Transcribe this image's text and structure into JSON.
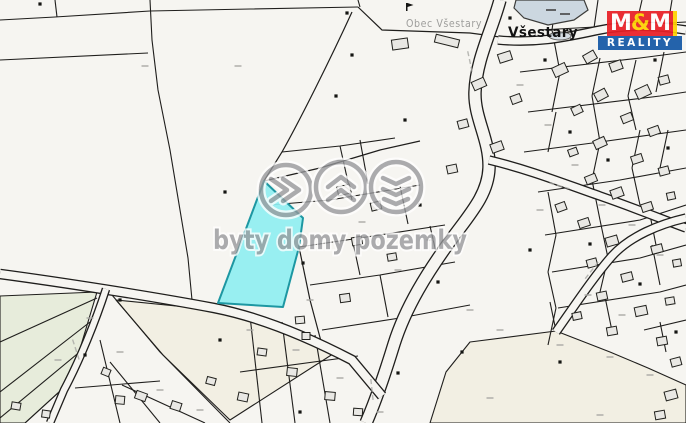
{
  "canvas": {
    "width": 686,
    "height": 423,
    "bg": "#f6f5f1",
    "line_color": "#1f1e1c",
    "building_fill": "#e9e8e4",
    "building_stroke": "#21211d",
    "green_fill": "#e7ecdb",
    "beige_fill": "#f2efe3",
    "pond_fill": "#ccd7e0",
    "pond_stroke": "#3c3c3a",
    "highlight_fill": "#8feef1",
    "highlight_stroke": "#1d97a2",
    "road_fill": "#f6f5f1",
    "mark_color": "#a8a8a4",
    "dot_color": "#141412"
  },
  "labels": {
    "town": "Všestary",
    "municipality": "Obec Všestary"
  },
  "watermark": {
    "text": "byty domy pozemky",
    "icons": [
      "fast-forward-icon",
      "roof-icon",
      "layers-icon"
    ],
    "color": "#96979a"
  },
  "logo": {
    "m1": "M",
    "amp": "&",
    "m2": "M",
    "bottom": "REALITY",
    "red": "#e81e25",
    "blue": "#1357a6",
    "yellow": "#ffd200"
  },
  "geometry": {
    "polygons": [
      {
        "kind": "green",
        "pts": [
          [
            0,
            296
          ],
          [
            97,
            292
          ],
          [
            70,
            382
          ],
          [
            25,
            423
          ],
          [
            0,
            423
          ]
        ]
      },
      {
        "kind": "beige",
        "pts": [
          [
            116,
            300
          ],
          [
            216,
            310
          ],
          [
            280,
            328
          ],
          [
            336,
            352
          ],
          [
            230,
            420
          ],
          [
            163,
            355
          ]
        ]
      },
      {
        "kind": "beige",
        "pts": [
          [
            430,
            423
          ],
          [
            446,
            372
          ],
          [
            470,
            342
          ],
          [
            556,
            331
          ],
          [
            610,
            352
          ],
          [
            648,
            368
          ],
          [
            686,
            385
          ],
          [
            686,
            423
          ]
        ]
      }
    ],
    "lines": [
      [
        150,
        0,
        152,
        40,
        158,
        90,
        170,
        150,
        180,
        210,
        188,
        258,
        192,
        300
      ],
      [
        0,
        20,
        55,
        17,
        150,
        11
      ],
      [
        55,
        0,
        57,
        17
      ],
      [
        0,
        60,
        148,
        53
      ],
      [
        150,
        11,
        250,
        9,
        358,
        7
      ],
      [
        358,
        0,
        360,
        7
      ],
      [
        282,
        152,
        340,
        146,
        395,
        138
      ],
      [
        270,
        205,
        330,
        200,
        420,
        185
      ],
      [
        299,
        247,
        360,
        238,
        445,
        225
      ],
      [
        310,
        285,
        380,
        275,
        455,
        262
      ],
      [
        322,
        330,
        400,
        318,
        470,
        305
      ],
      [
        340,
        146,
        352,
        200
      ],
      [
        360,
        140,
        368,
        184
      ],
      [
        352,
        238,
        360,
        275
      ],
      [
        400,
        186,
        408,
        224
      ],
      [
        380,
        275,
        388,
        317
      ],
      [
        430,
        226,
        438,
        261
      ],
      [
        540,
        30,
        686,
        22
      ],
      [
        520,
        72,
        640,
        58,
        686,
        52
      ],
      [
        528,
        112,
        660,
        96,
        686,
        92
      ],
      [
        524,
        152,
        600,
        142,
        686,
        130
      ],
      [
        538,
        192,
        620,
        180,
        686,
        168
      ],
      [
        545,
        235,
        640,
        220,
        686,
        205
      ],
      [
        552,
        272,
        640,
        258,
        686,
        245
      ],
      [
        558,
        308,
        660,
        292,
        686,
        285
      ],
      [
        644,
        330,
        686,
        320
      ],
      [
        556,
        0,
        552,
        30
      ],
      [
        598,
        0,
        594,
        28
      ],
      [
        642,
        0,
        636,
        26
      ],
      [
        672,
        0,
        668,
        24
      ],
      [
        552,
        30,
        560,
        72
      ],
      [
        560,
        72,
        552,
        112
      ],
      [
        556,
        112,
        548,
        152
      ],
      [
        600,
        58,
        592,
        96
      ],
      [
        592,
        96,
        600,
        142
      ],
      [
        636,
        60,
        628,
        96
      ],
      [
        628,
        96,
        636,
        130
      ],
      [
        664,
        52,
        656,
        92
      ],
      [
        600,
        142,
        592,
        180
      ],
      [
        640,
        130,
        632,
        168
      ],
      [
        668,
        130,
        660,
        168
      ],
      [
        548,
        192,
        556,
        235
      ],
      [
        592,
        180,
        600,
        220
      ],
      [
        632,
        168,
        640,
        205
      ],
      [
        556,
        235,
        548,
        272
      ],
      [
        600,
        220,
        608,
        258
      ],
      [
        648,
        205,
        656,
        245
      ],
      [
        548,
        272,
        556,
        308
      ],
      [
        608,
        258,
        600,
        292
      ],
      [
        652,
        245,
        660,
        285
      ],
      [
        556,
        308,
        548,
        345
      ],
      [
        604,
        292,
        612,
        331
      ],
      [
        660,
        322,
        666,
        352
      ],
      [
        97,
        298,
        0,
        342
      ],
      [
        90,
        322,
        0,
        392
      ],
      [
        82,
        350,
        0,
        418
      ],
      [
        70,
        382,
        25,
        423
      ],
      [
        112,
        295,
        160,
        352,
        230,
        423
      ],
      [
        100,
        340,
        120,
        423
      ],
      [
        110,
        362,
        160,
        423
      ],
      [
        122,
        385,
        205,
        423
      ],
      [
        75,
        388,
        160,
        381
      ],
      [
        250,
        316,
        262,
        423
      ],
      [
        282,
        322,
        295,
        423
      ],
      [
        315,
        335,
        330,
        423
      ],
      [
        240,
        372,
        358,
        356
      ],
      [
        556,
        331,
        550,
        302
      ]
    ],
    "curves": [
      "M352,12 C330,60 300,120 282,152 L264,181",
      "M358,7 L382,30 L470,33 L500,37",
      "M264,181 L320,168 L380,150 L420,141",
      "M299,247 L310,300 L322,345"
    ],
    "roads": [
      {
        "d": "M500,0 C492,30 476,60 475,92 C474,118 490,140 489,168 C488,196 468,216 448,244 C428,272 406,306 394,344 C386,370 376,400 366,423",
        "w": 11
      },
      {
        "d": "M0,274 C60,282 150,296 214,308 C260,317 306,336 352,360 L382,396",
        "w": 8
      },
      {
        "d": "M106,289 C96,320 80,360 64,390 L50,423",
        "w": 6
      },
      {
        "d": "M498,40 C540,44 570,36 600,30 C630,24 660,26 686,30",
        "w": 7
      },
      {
        "d": "M489,160 C530,170 560,182 600,196 C640,210 664,220 686,228",
        "w": 7
      },
      {
        "d": "M556,332 C575,305 595,275 612,256 C630,236 660,224 686,218",
        "w": 7
      }
    ],
    "pond": [
      [
        516,
        0
      ],
      [
        584,
        0
      ],
      [
        588,
        10
      ],
      [
        574,
        20
      ],
      [
        548,
        25
      ],
      [
        524,
        18
      ],
      [
        514,
        8
      ]
    ],
    "pond2": {
      "cx": 560,
      "cy": 36,
      "rx": 11,
      "ry": 4
    },
    "highlight": [
      [
        264,
        181
      ],
      [
        303,
        218
      ],
      [
        299,
        247
      ],
      [
        283,
        307
      ],
      [
        218,
        303
      ]
    ],
    "buildings": [
      [
        400,
        44,
        16,
        10,
        -8
      ],
      [
        447,
        41,
        24,
        8,
        14
      ],
      [
        505,
        57,
        13,
        9,
        -18
      ],
      [
        479,
        84,
        13,
        9,
        -24
      ],
      [
        516,
        99,
        10,
        8,
        -20
      ],
      [
        463,
        124,
        10,
        8,
        -15
      ],
      [
        497,
        147,
        12,
        9,
        -20
      ],
      [
        452,
        169,
        10,
        8,
        -12
      ],
      [
        344,
        190,
        13,
        9,
        -14
      ],
      [
        376,
        206,
        10,
        8,
        -14
      ],
      [
        357,
        241,
        10,
        8,
        -10
      ],
      [
        392,
        257,
        9,
        7,
        -10
      ],
      [
        345,
        298,
        10,
        8,
        -8
      ],
      [
        300,
        320,
        9,
        7,
        -5
      ],
      [
        306,
        336,
        8,
        7,
        0
      ],
      [
        560,
        70,
        14,
        10,
        -25
      ],
      [
        590,
        57,
        12,
        9,
        -30
      ],
      [
        616,
        66,
        12,
        9,
        -20
      ],
      [
        643,
        92,
        14,
        10,
        -25
      ],
      [
        664,
        80,
        10,
        8,
        -15
      ],
      [
        601,
        95,
        12,
        9,
        -28
      ],
      [
        577,
        110,
        10,
        8,
        -25
      ],
      [
        627,
        118,
        11,
        8,
        -22
      ],
      [
        654,
        131,
        11,
        8,
        -20
      ],
      [
        600,
        143,
        12,
        9,
        -24
      ],
      [
        573,
        152,
        9,
        7,
        -20
      ],
      [
        637,
        159,
        11,
        8,
        -18
      ],
      [
        664,
        171,
        10,
        8,
        -15
      ],
      [
        591,
        179,
        11,
        8,
        -22
      ],
      [
        617,
        193,
        12,
        9,
        -20
      ],
      [
        647,
        207,
        11,
        8,
        -18
      ],
      [
        671,
        196,
        8,
        7,
        -12
      ],
      [
        561,
        207,
        10,
        8,
        -20
      ],
      [
        584,
        223,
        11,
        8,
        -18
      ],
      [
        612,
        241,
        12,
        9,
        -16
      ],
      [
        657,
        249,
        11,
        8,
        -14
      ],
      [
        677,
        263,
        8,
        7,
        -10
      ],
      [
        592,
        263,
        10,
        8,
        -15
      ],
      [
        627,
        277,
        11,
        8,
        -14
      ],
      [
        602,
        296,
        10,
        8,
        -12
      ],
      [
        641,
        311,
        12,
        9,
        -12
      ],
      [
        670,
        301,
        9,
        7,
        -10
      ],
      [
        577,
        316,
        9,
        7,
        -12
      ],
      [
        612,
        331,
        10,
        8,
        -10
      ],
      [
        662,
        341,
        10,
        8,
        -10
      ],
      [
        676,
        362,
        10,
        8,
        -15
      ],
      [
        671,
        395,
        12,
        9,
        -15
      ],
      [
        660,
        415,
        10,
        8,
        -10
      ],
      [
        141,
        396,
        11,
        8,
        20
      ],
      [
        176,
        406,
        10,
        8,
        18
      ],
      [
        211,
        381,
        9,
        7,
        15
      ],
      [
        243,
        397,
        10,
        8,
        12
      ],
      [
        106,
        372,
        8,
        7,
        22
      ],
      [
        16,
        406,
        9,
        7,
        10
      ],
      [
        46,
        414,
        8,
        7,
        8
      ],
      [
        120,
        400,
        9,
        8,
        5
      ],
      [
        262,
        352,
        9,
        7,
        8
      ],
      [
        292,
        372,
        10,
        8,
        6
      ],
      [
        330,
        396,
        10,
        8,
        5
      ],
      [
        358,
        412,
        9,
        7,
        4
      ]
    ],
    "dots": [
      [
        40,
        4
      ],
      [
        352,
        55
      ],
      [
        336,
        96
      ],
      [
        303,
        263
      ],
      [
        225,
        192
      ],
      [
        420,
        205
      ],
      [
        438,
        282
      ],
      [
        462,
        352
      ],
      [
        510,
        18
      ],
      [
        545,
        60
      ],
      [
        570,
        132
      ],
      [
        608,
        160
      ],
      [
        668,
        148
      ],
      [
        590,
        244
      ],
      [
        640,
        284
      ],
      [
        676,
        332
      ],
      [
        560,
        362
      ],
      [
        300,
        412
      ],
      [
        220,
        340
      ],
      [
        120,
        300
      ],
      [
        347,
        13
      ],
      [
        405,
        120
      ],
      [
        530,
        250
      ],
      [
        655,
        60
      ],
      [
        85,
        355
      ],
      [
        398,
        373
      ]
    ],
    "marks": [
      [
        145,
        66
      ],
      [
        90,
        318
      ],
      [
        58,
        360
      ],
      [
        120,
        352
      ],
      [
        160,
        390
      ],
      [
        200,
        410
      ],
      [
        250,
        330
      ],
      [
        296,
        350
      ],
      [
        340,
        378
      ],
      [
        380,
        412
      ],
      [
        490,
        398
      ],
      [
        560,
        345
      ],
      [
        610,
        357
      ],
      [
        650,
        375
      ],
      [
        600,
        415
      ],
      [
        340,
        160
      ],
      [
        362,
        222
      ],
      [
        398,
        270
      ],
      [
        430,
        240
      ],
      [
        520,
        85
      ],
      [
        548,
        125
      ],
      [
        575,
        165
      ],
      [
        602,
        205
      ],
      [
        632,
        225
      ],
      [
        660,
        255
      ],
      [
        588,
        295
      ],
      [
        622,
        315
      ],
      [
        540,
        210
      ],
      [
        310,
        300
      ],
      [
        470,
        310
      ],
      [
        500,
        330
      ],
      [
        238,
        66
      ]
    ],
    "streets": [
      [
        470,
        62,
        78
      ],
      [
        372,
        390,
        84
      ],
      [
        592,
        270,
        -52
      ],
      [
        560,
        186,
        16
      ],
      [
        76,
        350,
        72
      ]
    ],
    "symbol": [
      406,
      3
    ]
  }
}
